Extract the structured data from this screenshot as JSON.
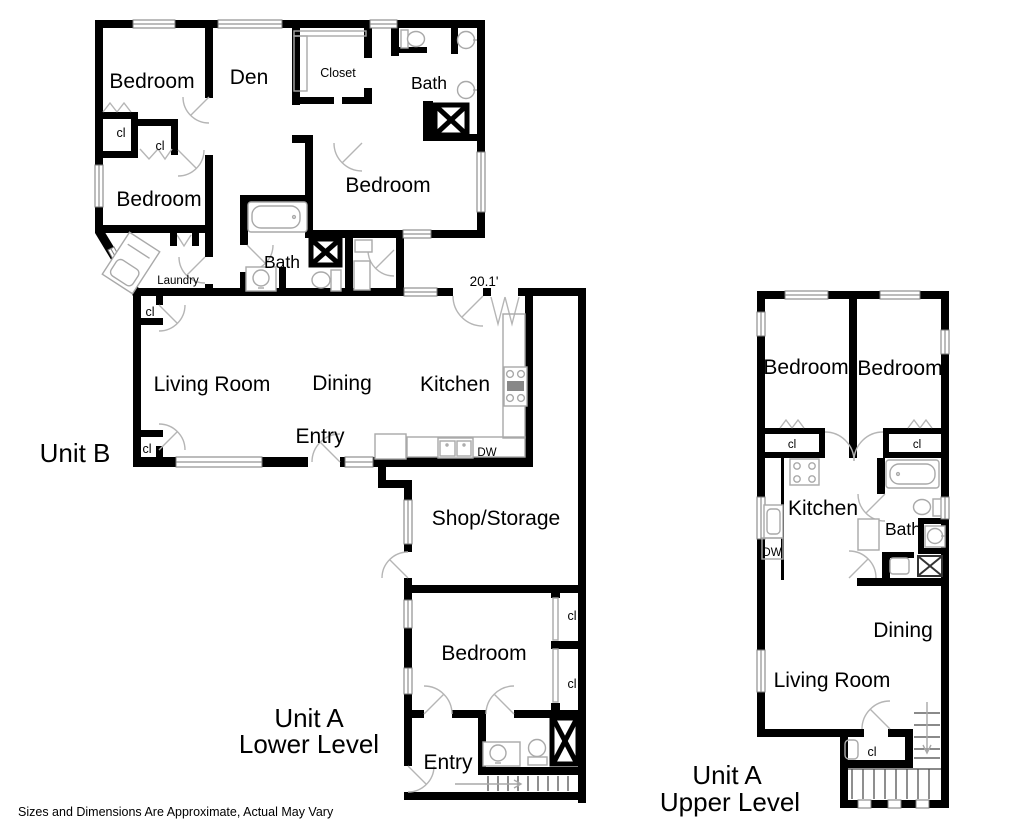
{
  "disclaimer": "Sizes and Dimensions Are Approximate, Actual May Vary",
  "unit_b": {
    "title": "Unit B",
    "dimension_label": "20.1'",
    "rooms": {
      "bedroom_top_left": "Bedroom",
      "den": "Den",
      "closet": "Closet",
      "bath_top": "Bath",
      "closet_1": "cl",
      "closet_2": "cl",
      "bedroom_left": "Bedroom",
      "bedroom_right": "Bedroom",
      "laundry": "Laundry",
      "bath_mid": "Bath",
      "closet_3": "cl",
      "living_room": "Living Room",
      "dining": "Dining",
      "kitchen": "Kitchen",
      "entry": "Entry",
      "closet_4": "cl",
      "dishwasher": "DW"
    }
  },
  "unit_a_lower": {
    "title_line1": "Unit A",
    "title_line2": "Lower Level",
    "rooms": {
      "shop_storage": "Shop/Storage",
      "bedroom": "Bedroom",
      "closet_1": "cl",
      "closet_2": "cl",
      "entry": "Entry"
    }
  },
  "unit_a_upper": {
    "title_line1": "Unit A",
    "title_line2": "Upper Level",
    "rooms": {
      "bedroom_left": "Bedroom",
      "bedroom_right": "Bedroom",
      "closet_1": "cl",
      "closet_2": "cl",
      "kitchen": "Kitchen",
      "bath": "Bath",
      "dishwasher": "DW",
      "dining": "Dining",
      "living_room": "Living Room",
      "closet_3": "cl"
    }
  },
  "colors": {
    "wall": "#000000",
    "background": "#ffffff",
    "fixture": "#a9a9a9"
  }
}
